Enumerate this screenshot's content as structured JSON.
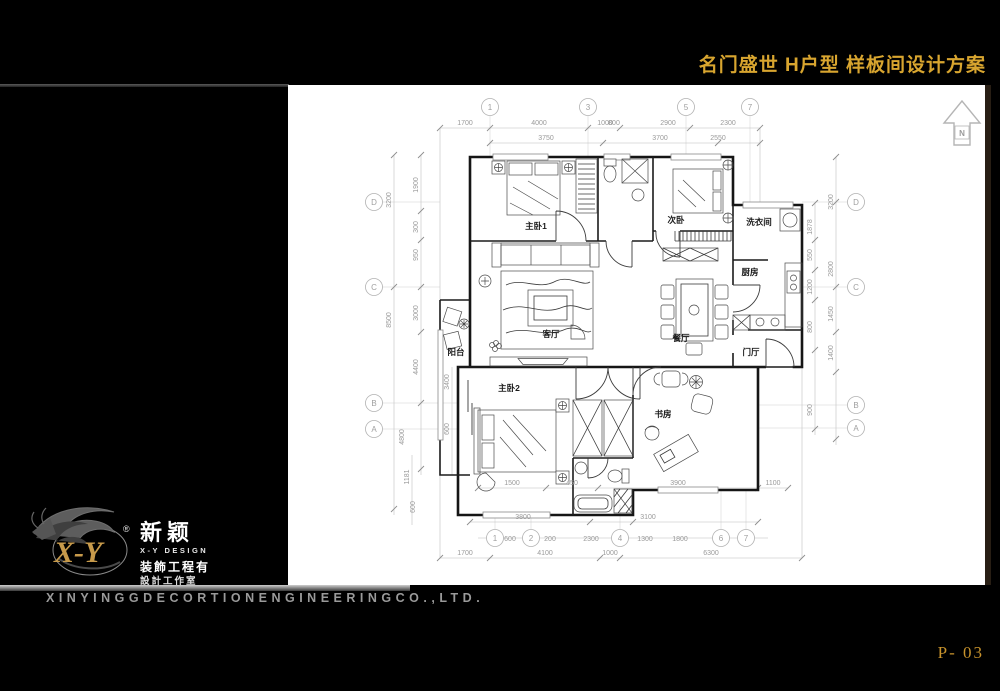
{
  "colors": {
    "accent_gold": "#d8a52f",
    "page_gold": "#c8932c",
    "company_gray": "#9a9a9a",
    "canvas": "#ffffff",
    "background": "#000000"
  },
  "header": {
    "title": "名门盛世 H户型 样板间设计方案"
  },
  "footer": {
    "company": "XINYINGGDECORTIONENGINEERINGCO.,LTD.",
    "page": "P- 03"
  },
  "logo": {
    "xy": "X-Y",
    "reg": "®",
    "cn": "新颖",
    "en": "X-Y DESIGN",
    "line1": "装飾工程有",
    "line2": "設計工作室"
  },
  "plan": {
    "north_label": "N",
    "room_labels": [
      {
        "label": "主卧1",
        "x": 248,
        "y": 144
      },
      {
        "label": "次卧",
        "x": 388,
        "y": 138
      },
      {
        "label": "洗衣间",
        "x": 471,
        "y": 140
      },
      {
        "label": "厨房",
        "x": 462,
        "y": 190
      },
      {
        "label": "客厅",
        "x": 263,
        "y": 252
      },
      {
        "label": "餐厅",
        "x": 393,
        "y": 256
      },
      {
        "label": "门厅",
        "x": 463,
        "y": 270
      },
      {
        "label": "阳台",
        "x": 168,
        "y": 270
      },
      {
        "label": "主卧2",
        "x": 221,
        "y": 306
      },
      {
        "label": "书房",
        "x": 375,
        "y": 332
      }
    ],
    "grid_bubbles": [
      {
        "label": "1",
        "x": 202,
        "y": 22
      },
      {
        "label": "3",
        "x": 300,
        "y": 22
      },
      {
        "label": "5",
        "x": 398,
        "y": 22
      },
      {
        "label": "7",
        "x": 462,
        "y": 22
      },
      {
        "label": "1",
        "x": 207,
        "y": 453
      },
      {
        "label": "2",
        "x": 243,
        "y": 453
      },
      {
        "label": "4",
        "x": 332,
        "y": 453
      },
      {
        "label": "6",
        "x": 433,
        "y": 453
      },
      {
        "label": "7",
        "x": 458,
        "y": 453
      },
      {
        "label": "D",
        "x": 86,
        "y": 117
      },
      {
        "label": "C",
        "x": 86,
        "y": 202
      },
      {
        "label": "B",
        "x": 86,
        "y": 318
      },
      {
        "label": "A",
        "x": 86,
        "y": 344
      },
      {
        "label": "D",
        "x": 568,
        "y": 117
      },
      {
        "label": "C",
        "x": 568,
        "y": 202
      },
      {
        "label": "B",
        "x": 568,
        "y": 320
      },
      {
        "label": "A",
        "x": 568,
        "y": 343
      }
    ],
    "dim_labels": [
      {
        "text": "1700",
        "x": 177,
        "y": 40
      },
      {
        "text": "4000",
        "x": 251,
        "y": 40
      },
      {
        "text": "1000",
        "x": 317,
        "y": 40
      },
      {
        "text": "800",
        "x": 326,
        "y": 40
      },
      {
        "text": "2900",
        "x": 380,
        "y": 40
      },
      {
        "text": "2300",
        "x": 440,
        "y": 40
      },
      {
        "text": "3750",
        "x": 258,
        "y": 55
      },
      {
        "text": "3700",
        "x": 372,
        "y": 55
      },
      {
        "text": "2550",
        "x": 430,
        "y": 55
      },
      {
        "text": "1500",
        "x": 224,
        "y": 400
      },
      {
        "text": "450",
        "x": 284,
        "y": 400
      },
      {
        "text": "3900",
        "x": 390,
        "y": 400
      },
      {
        "text": "1100",
        "x": 485,
        "y": 400
      },
      {
        "text": "3800",
        "x": 235,
        "y": 434
      },
      {
        "text": "3100",
        "x": 360,
        "y": 434
      },
      {
        "text": "600",
        "x": 222,
        "y": 456
      },
      {
        "text": "200",
        "x": 262,
        "y": 456
      },
      {
        "text": "2300",
        "x": 303,
        "y": 456
      },
      {
        "text": "1300",
        "x": 357,
        "y": 456
      },
      {
        "text": "1800",
        "x": 392,
        "y": 456
      },
      {
        "text": "1700",
        "x": 177,
        "y": 470
      },
      {
        "text": "4100",
        "x": 257,
        "y": 470
      },
      {
        "text": "1000",
        "x": 322,
        "y": 470
      },
      {
        "text": "6300",
        "x": 423,
        "y": 470
      },
      {
        "text": "3200",
        "x": 103,
        "y": 115,
        "rot": -90
      },
      {
        "text": "8500",
        "x": 103,
        "y": 235,
        "rot": -90
      },
      {
        "text": "4800",
        "x": 116,
        "y": 352,
        "rot": -90
      },
      {
        "text": "1900",
        "x": 130,
        "y": 100,
        "rot": -90
      },
      {
        "text": "300",
        "x": 130,
        "y": 142,
        "rot": -90
      },
      {
        "text": "950",
        "x": 130,
        "y": 170,
        "rot": -90
      },
      {
        "text": "3000",
        "x": 130,
        "y": 228,
        "rot": -90
      },
      {
        "text": "4400",
        "x": 130,
        "y": 282,
        "rot": -90
      },
      {
        "text": "3400",
        "x": 161,
        "y": 297,
        "rot": -90
      },
      {
        "text": "600",
        "x": 161,
        "y": 344,
        "rot": -90
      },
      {
        "text": "1181",
        "x": 121,
        "y": 392,
        "rot": -90
      },
      {
        "text": "600",
        "x": 127,
        "y": 422,
        "rot": -90
      },
      {
        "text": "3200",
        "x": 545,
        "y": 117,
        "rot": -90
      },
      {
        "text": "2800",
        "x": 545,
        "y": 184,
        "rot": -90
      },
      {
        "text": "1450",
        "x": 545,
        "y": 229,
        "rot": -90
      },
      {
        "text": "1400",
        "x": 545,
        "y": 268,
        "rot": -90
      },
      {
        "text": "1878",
        "x": 524,
        "y": 142,
        "rot": -90
      },
      {
        "text": "550",
        "x": 524,
        "y": 170,
        "rot": -90
      },
      {
        "text": "1200",
        "x": 524,
        "y": 202,
        "rot": -90
      },
      {
        "text": "800",
        "x": 524,
        "y": 242,
        "rot": -90
      },
      {
        "text": "900",
        "x": 524,
        "y": 325,
        "rot": -90
      }
    ]
  }
}
